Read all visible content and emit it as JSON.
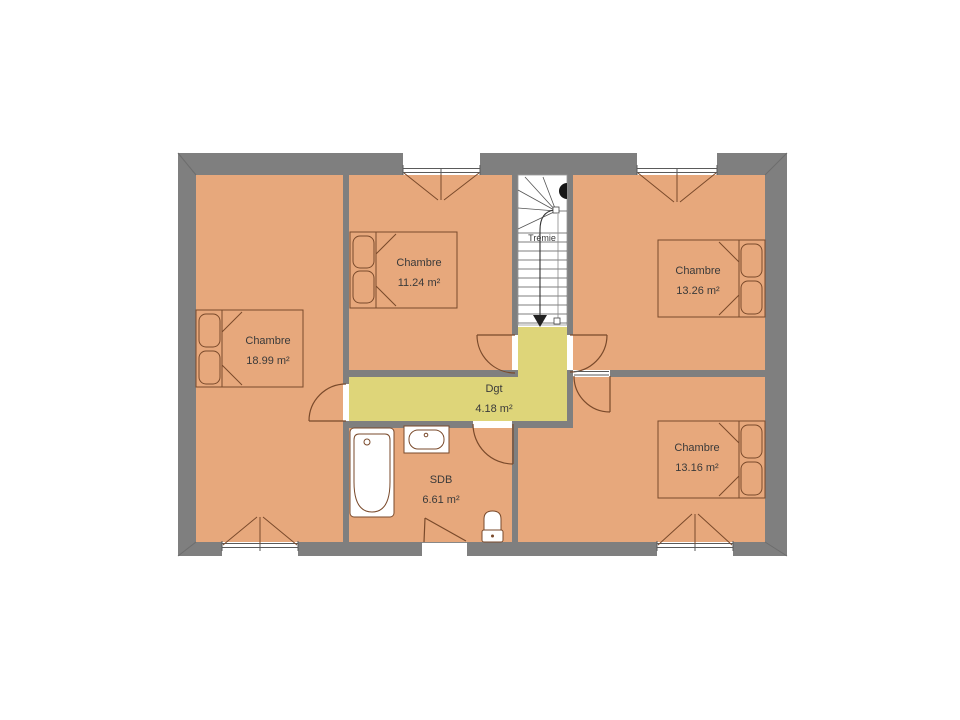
{
  "floor_plan": {
    "rooms": [
      {
        "name": "Chambre",
        "area": "18.99 m²"
      },
      {
        "name": "Chambre",
        "area": "11.24 m²"
      },
      {
        "name": "Chambre",
        "area": "13.26 m²"
      },
      {
        "name": "Chambre",
        "area": "13.16 m²"
      },
      {
        "name": "SDB",
        "area": "6.61 m²"
      },
      {
        "name": "Dgt",
        "area": "4.18 m²"
      },
      {
        "name": "Trémie",
        "area": ""
      }
    ],
    "colors": {
      "room_fill": "#e7a87c",
      "hallway_fill": "#ded579",
      "stairwell_fill": "#ffffff",
      "wall": "#7f7f7f",
      "furniture_outline": "#7a4a2b",
      "label_text": "#3a3a3a"
    }
  }
}
